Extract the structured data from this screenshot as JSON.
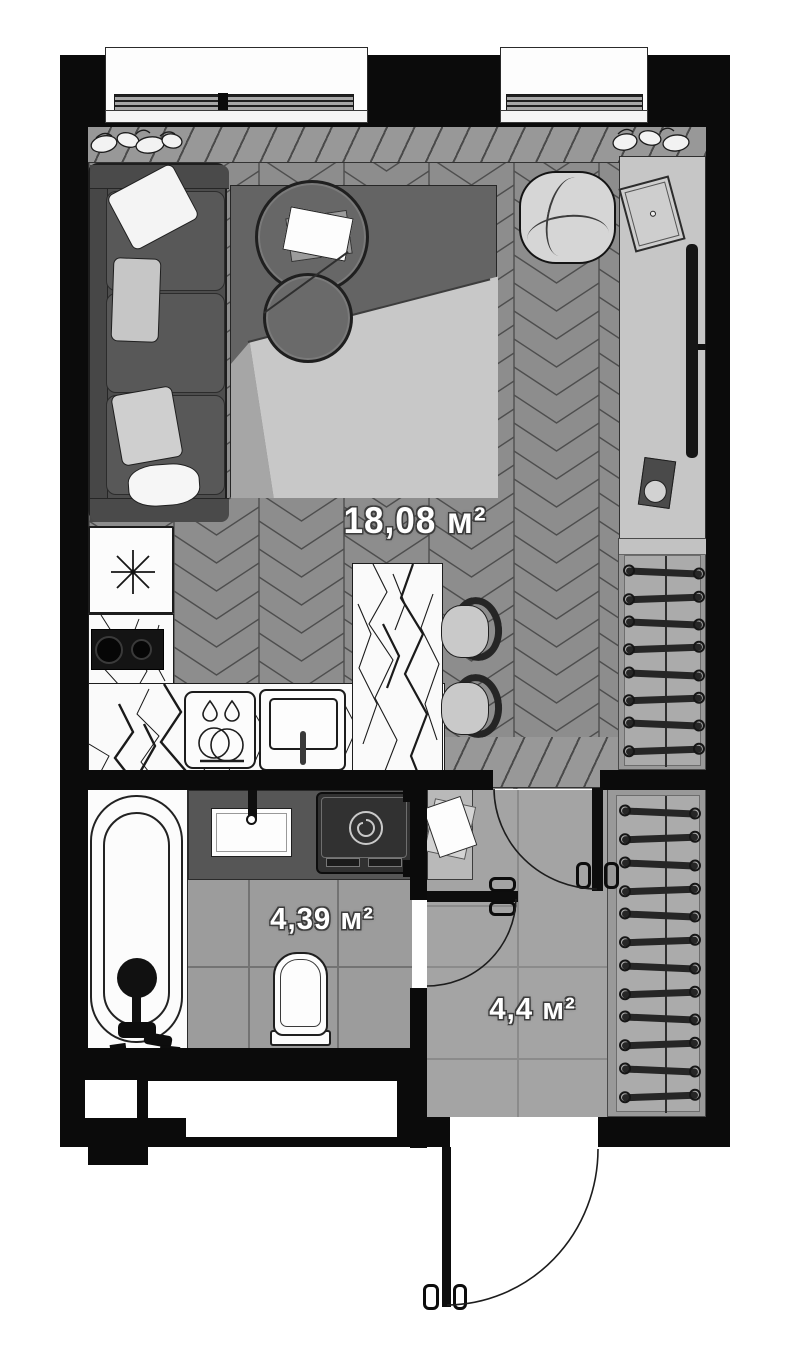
{
  "plan": {
    "type": "apartment-floor-plan-studio",
    "rooms": [
      {
        "id": "living-room-kitchen",
        "area_label": "18,08 м²"
      },
      {
        "id": "bathroom",
        "area_label": "4,39 м²"
      },
      {
        "id": "hallway",
        "area_label": "4,4 м²"
      }
    ],
    "fixture_icons": [
      "window-icon",
      "plant-icon",
      "sofa-icon",
      "pillow-icon",
      "rug-icon",
      "coffee-table-icon",
      "tray-icon",
      "ottoman-icon",
      "tv-console-icon",
      "tv-icon",
      "wardrobe-hanger-icon",
      "fridge-asterisk-icon",
      "cooktop-icon",
      "kitchen-sink-icon",
      "faucet-icon",
      "kitchen-island-icon",
      "bar-stool-icon",
      "bathtub-icon",
      "shower-head-icon",
      "washing-machine-icon",
      "toilet-icon",
      "bathroom-sink-icon",
      "door-leaf-icon",
      "door-swing-arc-icon",
      "entrance-door-icon",
      "console-table-icon",
      "paper-sheet-icon"
    ],
    "palette": {
      "wall": "#0b0b0b",
      "floor_main": "#8d8d8d",
      "floor_bathroom": "#9c9c9c",
      "floor_hallway": "#a4a4a4",
      "rug": "#646464",
      "counter_marble": "#fafafa",
      "label_text": "#ffffff"
    }
  }
}
